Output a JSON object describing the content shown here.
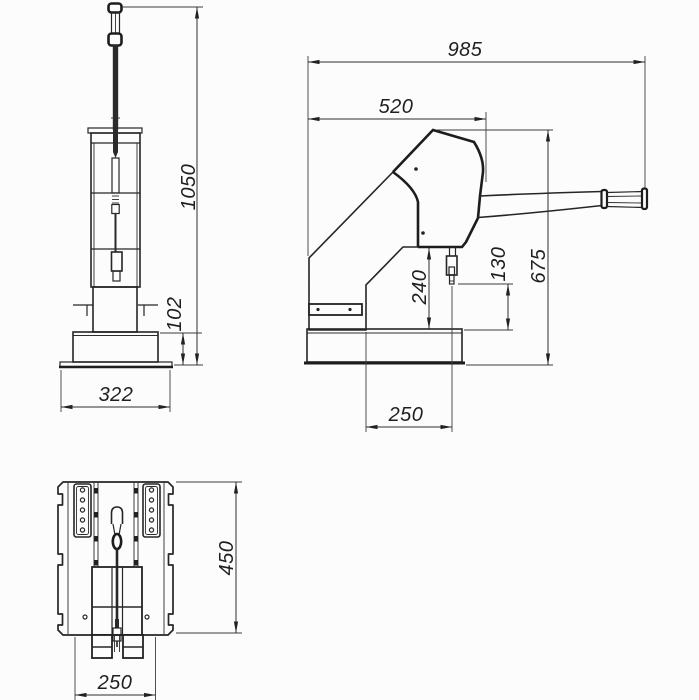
{
  "drawing": {
    "type": "technical-drawing-three-views",
    "background": "#fcfcfc",
    "line_color": "#262626",
    "views": [
      "front-view",
      "side-view",
      "plan-view"
    ],
    "dims": {
      "overall_height": "1050",
      "base_height": "102",
      "base_width": "322",
      "total_length": "985",
      "body_length": "520",
      "working_height": "675",
      "jaw_gap": "240",
      "throat_depth": "130",
      "base_length": "250",
      "plan_depth": "450",
      "plan_width": "250"
    }
  }
}
